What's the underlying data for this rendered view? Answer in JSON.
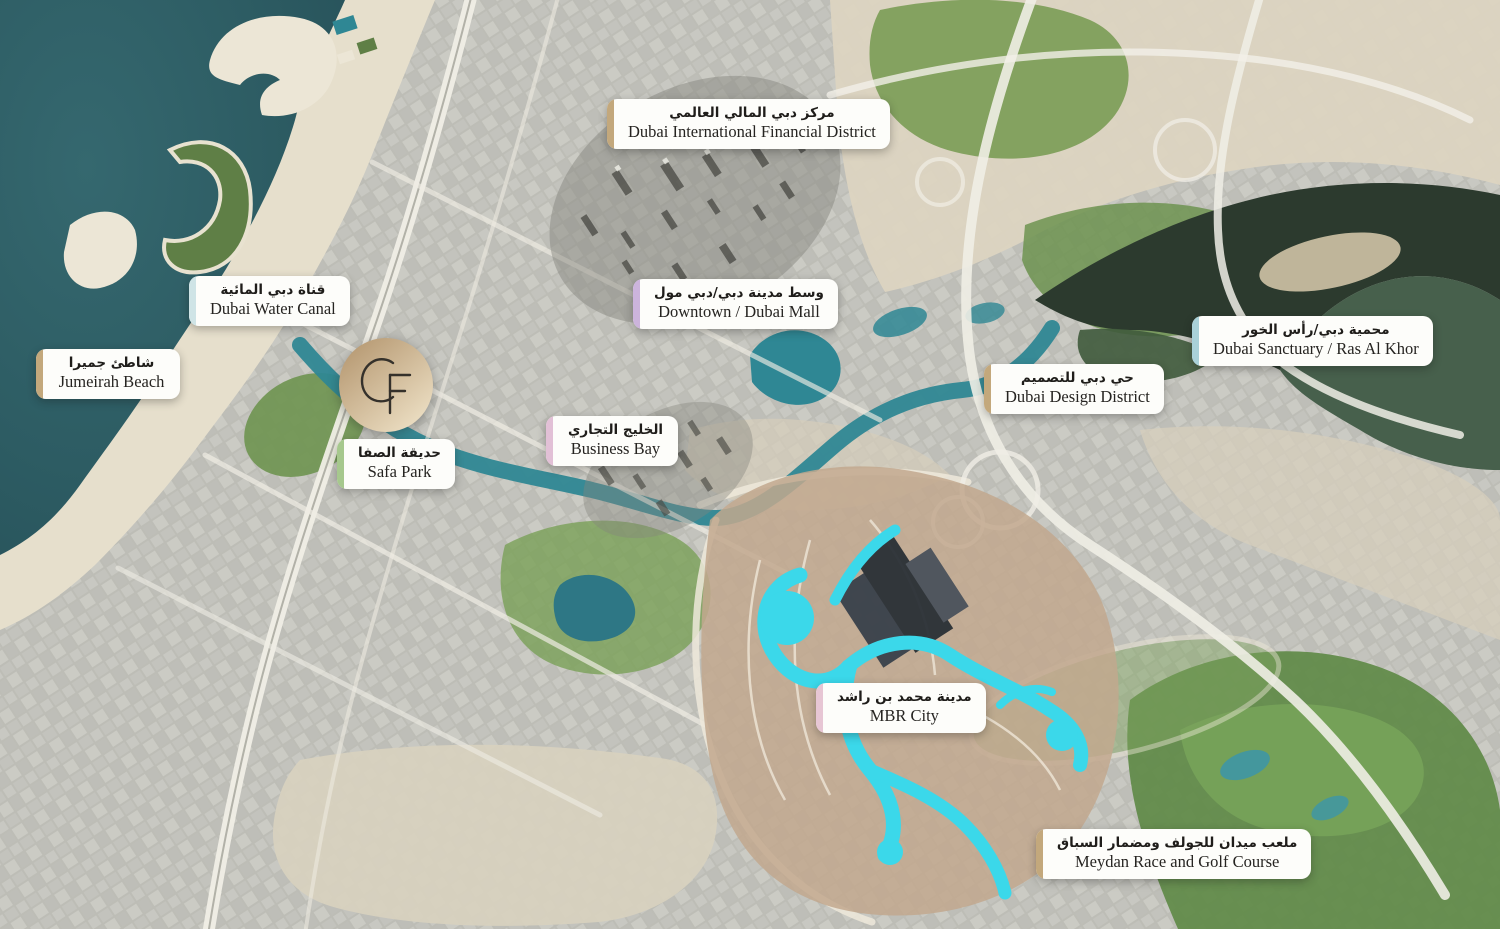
{
  "page": {
    "name": "Dubai destinations satellite map"
  },
  "logo": {
    "monogram": "CF",
    "gradient_start": "#b1926a",
    "gradient_end": "#eee1c6"
  },
  "labels": [
    {
      "id": "dubai-international-financial-district",
      "arabic": "مركز دبي المالي العالمي",
      "english": "Dubai International Financial District",
      "accent": "#c3a87c",
      "x": 607,
      "y": 99,
      "min_width": 252
    },
    {
      "id": "dubai-water-canal",
      "arabic": "قناة دبي المائية",
      "english": "Dubai Water Canal",
      "accent": "#cfe4e6",
      "x": 189,
      "y": 276,
      "min_width": 160
    },
    {
      "id": "jumeirah-beach",
      "arabic": "شاطئ جميرا",
      "english": "Jumeirah Beach",
      "accent": "#c3a87c",
      "x": 36,
      "y": 349,
      "min_width": 144
    },
    {
      "id": "downtown-dubai-mall",
      "arabic": "وسط مدينة دبي/دبي مول",
      "english": "Downtown / Dubai Mall",
      "accent": "#ccb4dc",
      "x": 633,
      "y": 279,
      "min_width": 178
    },
    {
      "id": "dubai-sanctuary-ras-al-khor",
      "arabic": "محمية دبي/رأس الخور",
      "english": "Dubai Sanctuary / Ras Al Khor",
      "accent": "#a9d1d8",
      "x": 1192,
      "y": 316,
      "min_width": 232
    },
    {
      "id": "dubai-design-district",
      "arabic": "حي دبي للتصميم",
      "english": "Dubai Design District",
      "accent": "#c3a87c",
      "x": 984,
      "y": 364,
      "min_width": 172
    },
    {
      "id": "business-bay",
      "arabic": "الخليج التجاري",
      "english": "Business Bay",
      "accent": "#e2c0d6",
      "x": 546,
      "y": 416,
      "min_width": 132
    },
    {
      "id": "safa-park",
      "arabic": "حديقة الصفا",
      "english": "Safa Park",
      "accent": "#a6c88d",
      "x": 337,
      "y": 439,
      "min_width": 112
    },
    {
      "id": "mbr-city",
      "arabic": "مدينة محمد بن راشد",
      "english": "MBR City",
      "accent": "#e7c6d4",
      "x": 816,
      "y": 683,
      "min_width": 148
    },
    {
      "id": "meydan-race-and-golf-course",
      "arabic": "ملعب ميدان للجولف ومضمار السباق",
      "english": "Meydan Race and Golf Course",
      "accent": "#c3a87c",
      "x": 1036,
      "y": 829,
      "min_width": 214
    }
  ]
}
